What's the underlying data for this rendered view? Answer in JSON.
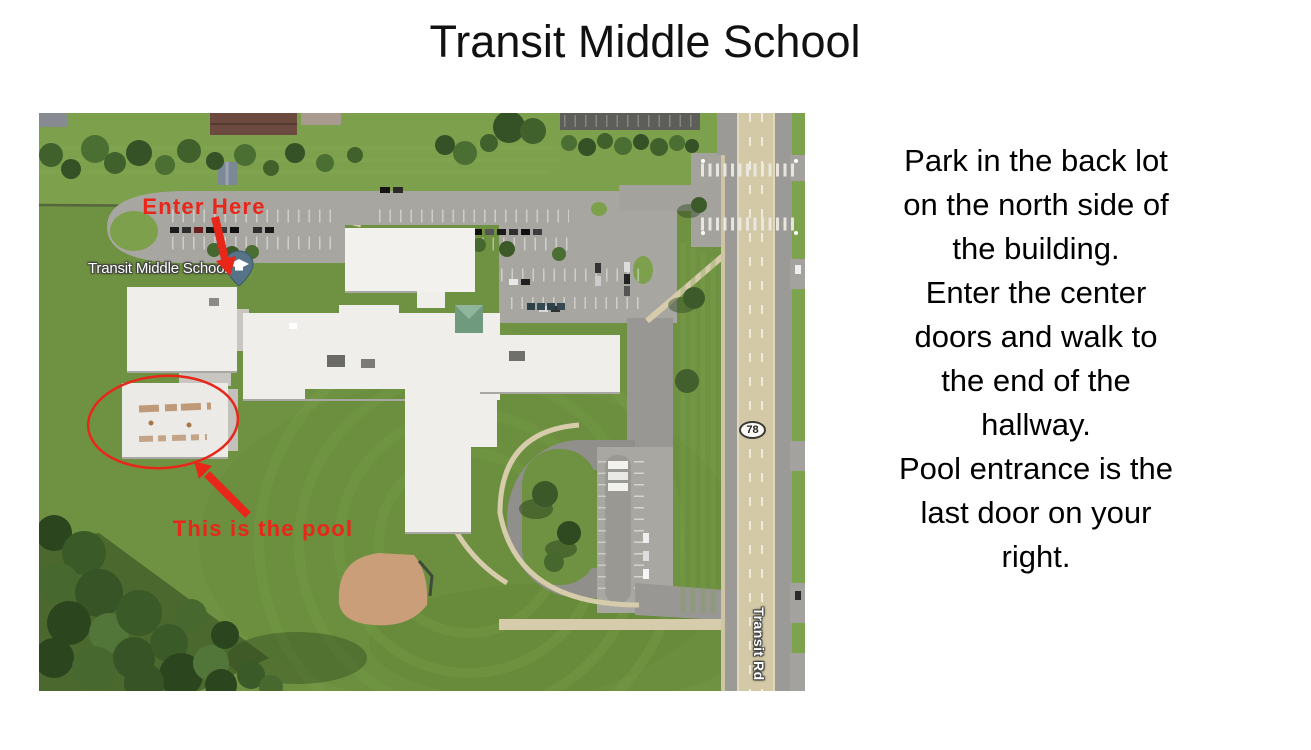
{
  "slide": {
    "title": "Transit Middle School"
  },
  "instructions": {
    "para1": {
      "lines": [
        "Park in the back lot",
        "on the north side of",
        "the building."
      ]
    },
    "para2": {
      "lines": [
        "Enter the center",
        "doors and walk to",
        "the end of the",
        "hallway."
      ]
    },
    "para3": {
      "lines": [
        "Pool entrance is the",
        "last door on your",
        "right."
      ]
    }
  },
  "map": {
    "labels": {
      "school_name": "Transit Middle School",
      "route_shield": "78",
      "road_name": "Transit Rd"
    },
    "annotations": {
      "enter_here": "Enter Here",
      "pool_callout": "This is the pool"
    },
    "colors": {
      "annotation_red": "#e8261a",
      "pin_blue": "#567488"
    }
  }
}
